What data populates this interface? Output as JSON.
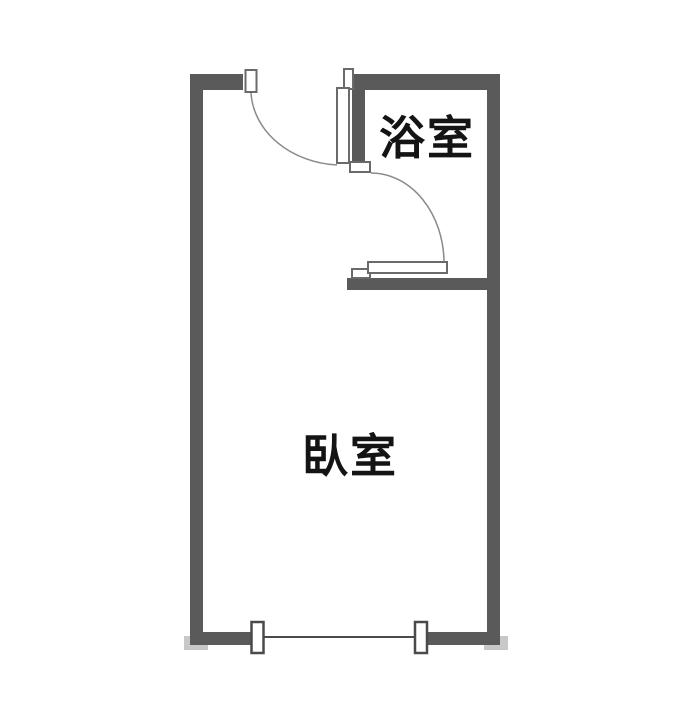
{
  "floor_plan": {
    "type": "apartment-floor-plan",
    "rooms": [
      {
        "id": "bathroom",
        "label": "浴室"
      },
      {
        "id": "bedroom",
        "label": "臥室"
      }
    ],
    "colors": {
      "wall": "#5a5a5a",
      "frame_stroke": "#6a6a6a",
      "arc": "#8a8a8a",
      "window_line": "#4a4a4a",
      "shadow": "#c8c8c8",
      "text": "#141414",
      "background": "#ffffff"
    }
  }
}
